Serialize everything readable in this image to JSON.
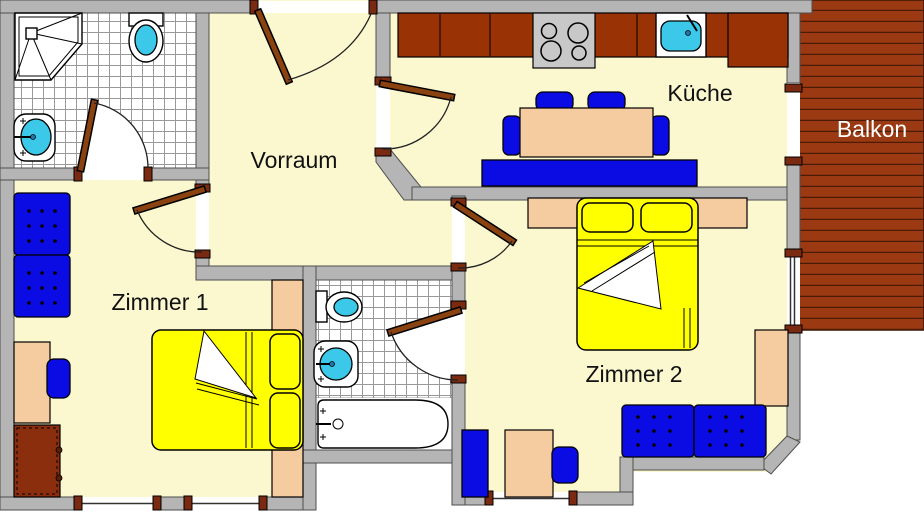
{
  "rooms": {
    "vorraum": {
      "label": "Vorraum"
    },
    "kueche": {
      "label": "Küche"
    },
    "balkon": {
      "label": "Balkon"
    },
    "zimmer1": {
      "label": "Zimmer 1"
    },
    "zimmer2": {
      "label": "Zimmer 2"
    }
  },
  "fixtures": [
    "shower-icon",
    "toilet-icon",
    "wash-basin-icon",
    "bathtub-icon",
    "stove-icon",
    "kitchen-sink-icon",
    "dining-table",
    "bench",
    "chair",
    "bed",
    "pillow",
    "sofa",
    "desk",
    "wardrobe",
    "dresser",
    "door",
    "window",
    "balcony-deck"
  ],
  "palette": {
    "wall": "#b5b5b5",
    "floor": "#fbf8d0",
    "blue": "#0b0be4",
    "cyan": "#3cc8e8",
    "yellow": "#ffff00",
    "counter": "#993305",
    "balcony": "#9b3a12",
    "plank": "#4a1c05",
    "leaf": "#8a4210",
    "post": "#7a2a10",
    "peach": "#f5cba0",
    "dresser": "#8b2e0e",
    "stove": "#c8c8c8",
    "labelDark": "#111111",
    "labelLight": "#ffffff"
  }
}
